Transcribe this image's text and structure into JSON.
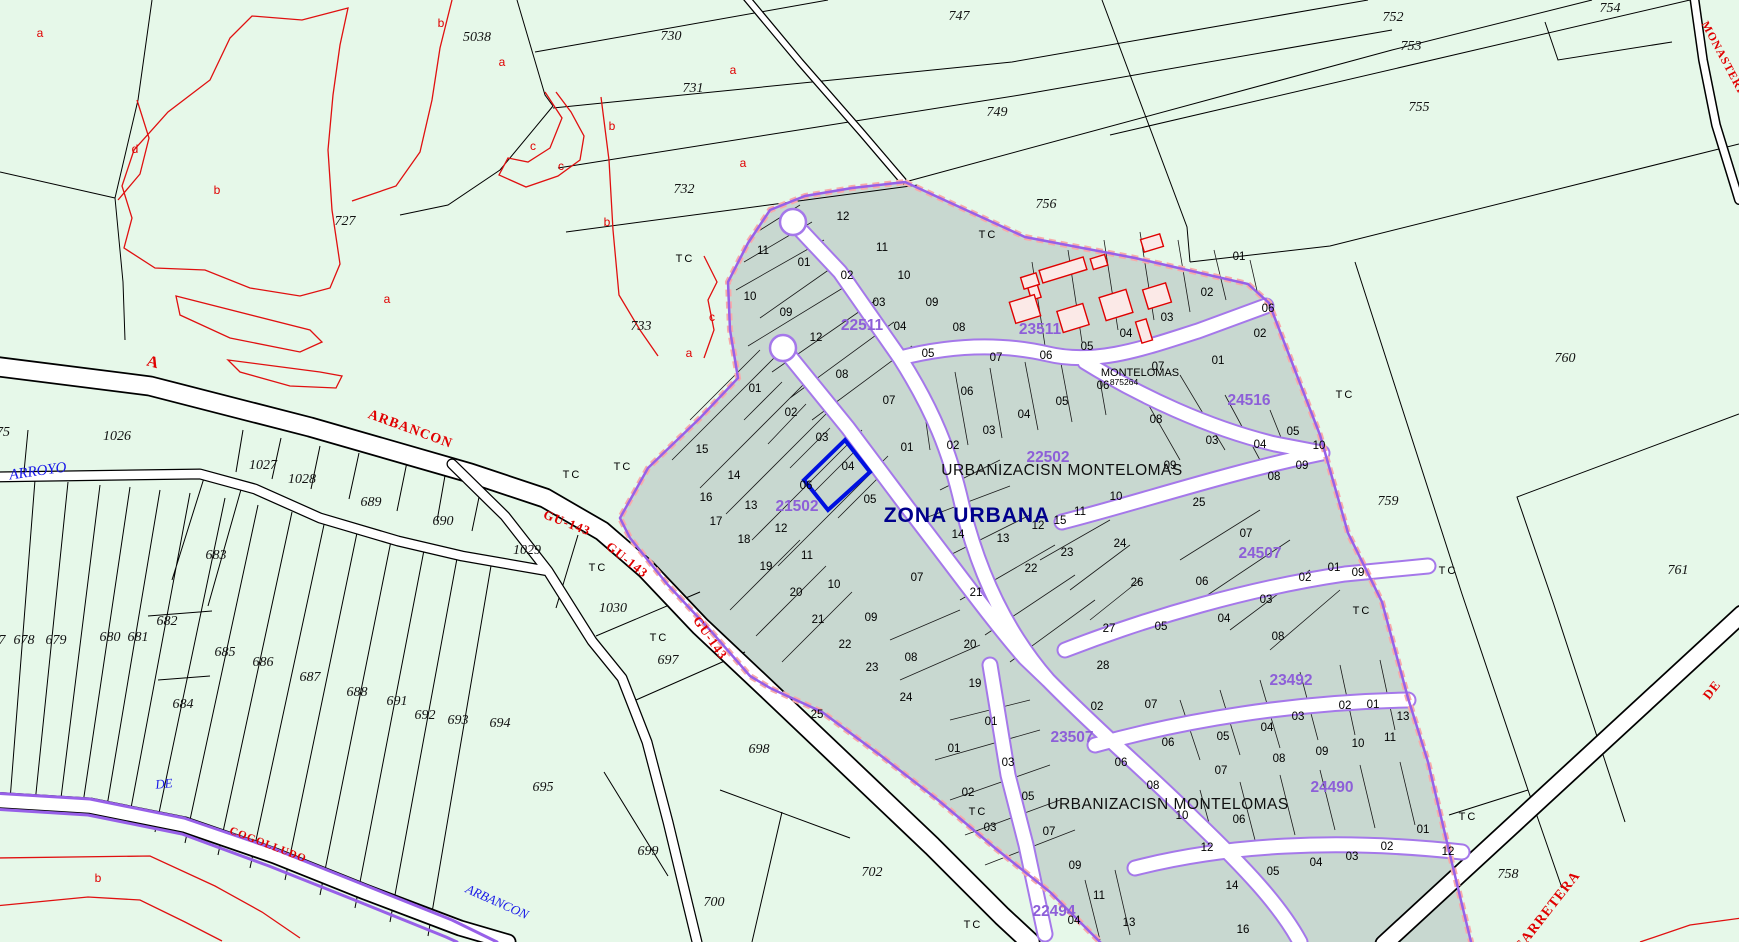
{
  "map": {
    "width": 1739,
    "height": 942,
    "colors": {
      "rural_fill": "#e6f8e9",
      "urban_fill": "#c8d8d0",
      "parcel_line": "#000000",
      "subparcel_red": "#e01010",
      "urban_boundary_purple": "#9760e8",
      "urban_boundary_pink": "#f8aaaa",
      "road_casing_purple": "#a578ea",
      "cadastral_ref_purple": "#8d5fd8",
      "hydro_blue": "#1818e8",
      "zone_navy": "#00008c",
      "selected_parcel_blue": "#0010e0",
      "house_fill": "#fbe9e7",
      "house_stroke": "#e00000"
    }
  },
  "labels": {
    "zone_label": [
      [
        967,
        516,
        "ZONA URBANA",
        0
      ]
    ],
    "urbanization_labels": [
      [
        1062,
        471,
        "URBANIZACISN MONTELOMAS",
        0
      ],
      [
        1168,
        805,
        "URBANIZACISN MONTELOMAS",
        0
      ]
    ],
    "small_labels": [
      [
        1140,
        373,
        "MONTELOMAS",
        0,
        11
      ],
      [
        1124,
        382,
        "875264",
        0,
        8.5
      ]
    ],
    "cadastral_refs": [
      [
        862,
        326,
        "22511",
        0
      ],
      [
        1040,
        330,
        "23511",
        0
      ],
      [
        1048,
        458,
        "22502",
        0
      ],
      [
        1249,
        401,
        "24516",
        0
      ],
      [
        797,
        507,
        "21502",
        0
      ],
      [
        1260,
        554,
        "24507",
        0
      ],
      [
        1291,
        681,
        "23492",
        0
      ],
      [
        1072,
        738,
        "23507",
        0
      ],
      [
        1332,
        788,
        "24490",
        0
      ],
      [
        1054,
        912,
        "22494",
        0
      ]
    ],
    "rural_parcel_numbers": [
      [
        477,
        38,
        "5038",
        0
      ],
      [
        345,
        222,
        "727",
        0
      ],
      [
        671,
        37,
        "730",
        0
      ],
      [
        693,
        89,
        "731",
        0
      ],
      [
        684,
        190,
        "732",
        0
      ],
      [
        641,
        327,
        "733",
        0
      ],
      [
        959,
        17,
        "747",
        0
      ],
      [
        997,
        113,
        "749",
        0
      ],
      [
        1046,
        205,
        "756",
        0
      ],
      [
        1393,
        18,
        "752",
        0
      ],
      [
        1411,
        47,
        "753",
        0
      ],
      [
        1610,
        9,
        "754",
        0
      ],
      [
        1419,
        108,
        "755",
        0
      ],
      [
        1565,
        359,
        "760",
        0
      ],
      [
        1388,
        502,
        "759",
        0
      ],
      [
        1678,
        571,
        "761",
        0
      ],
      [
        1508,
        875,
        "758",
        0
      ],
      [
        117,
        437,
        "1026",
        0
      ],
      [
        263,
        466,
        "1027",
        0
      ],
      [
        302,
        480,
        "1028",
        0
      ],
      [
        371,
        503,
        "689",
        0
      ],
      [
        443,
        522,
        "690",
        0
      ],
      [
        527,
        551,
        "1029",
        0
      ],
      [
        613,
        609,
        "1030",
        0
      ],
      [
        216,
        556,
        "683",
        0
      ],
      [
        3,
        433,
        "75",
        0
      ],
      [
        2,
        641,
        "7",
        0
      ],
      [
        24,
        641,
        "678",
        0
      ],
      [
        56,
        641,
        "679",
        0
      ],
      [
        110,
        638,
        "680",
        0
      ],
      [
        138,
        638,
        "681",
        0
      ],
      [
        167,
        622,
        "682",
        0
      ],
      [
        183,
        705,
        "684",
        0
      ],
      [
        225,
        653,
        "685",
        0
      ],
      [
        263,
        663,
        "686",
        0
      ],
      [
        310,
        678,
        "687",
        0
      ],
      [
        357,
        693,
        "688",
        0
      ],
      [
        397,
        702,
        "691",
        0
      ],
      [
        425,
        716,
        "692",
        0
      ],
      [
        458,
        721,
        "693",
        0
      ],
      [
        500,
        724,
        "694",
        0
      ],
      [
        543,
        788,
        "695",
        0
      ],
      [
        668,
        661,
        "697",
        0
      ],
      [
        759,
        750,
        "698",
        0
      ],
      [
        648,
        852,
        "699",
        0
      ],
      [
        714,
        903,
        "700",
        0
      ],
      [
        872,
        873,
        "702",
        0
      ]
    ],
    "tc_markers": [
      [
        685,
        259,
        "TC",
        0
      ],
      [
        988,
        235,
        "TC",
        0
      ],
      [
        572,
        475,
        "TC",
        0
      ],
      [
        623,
        467,
        "TC",
        0
      ],
      [
        598,
        568,
        "TC",
        0
      ],
      [
        659,
        638,
        "TC",
        0
      ],
      [
        1345,
        395,
        "TC",
        0
      ],
      [
        1448,
        571,
        "TC",
        0
      ],
      [
        1362,
        611,
        "TC",
        0
      ],
      [
        1468,
        817,
        "TC",
        0
      ],
      [
        978,
        812,
        "TC",
        0
      ],
      [
        973,
        925,
        "TC",
        0
      ]
    ],
    "subparcel_letters": [
      [
        40,
        33,
        "a",
        0
      ],
      [
        441,
        23,
        "b",
        0
      ],
      [
        502,
        62,
        "a",
        0
      ],
      [
        733,
        70,
        "a",
        0
      ],
      [
        612,
        126,
        "b",
        0
      ],
      [
        135,
        149,
        "d",
        0
      ],
      [
        533,
        146,
        "c",
        0
      ],
      [
        561,
        166,
        "c",
        0
      ],
      [
        743,
        163,
        "a",
        0
      ],
      [
        217,
        190,
        "b",
        0
      ],
      [
        607,
        222,
        "b",
        0
      ],
      [
        387,
        299,
        "a",
        0
      ],
      [
        712,
        317,
        "c",
        0
      ],
      [
        689,
        353,
        "a",
        0
      ],
      [
        98,
        878,
        "b",
        0
      ]
    ],
    "road_labels": [
      [
        410,
        430,
        "ARBANCON",
        20,
        14
      ],
      [
        567,
        523,
        "GU-143",
        21,
        13
      ],
      [
        627,
        560,
        "GU-143",
        38,
        13
      ],
      [
        710,
        638,
        "GU-143",
        55,
        13
      ],
      [
        268,
        845,
        "COGOLLUDO",
        21,
        11
      ],
      [
        1548,
        912,
        "CARRETERA",
        -52,
        14
      ],
      [
        1712,
        690,
        "DE",
        -52,
        13
      ],
      [
        1725,
        62,
        "MONASTERIO",
        62,
        11.5
      ],
      [
        153,
        363,
        "A",
        15,
        16
      ]
    ],
    "blue_labels": [
      [
        38,
        472,
        "ARROYO",
        -8,
        15
      ],
      [
        164,
        784,
        "DE",
        -5,
        13
      ],
      [
        497,
        902,
        "ARBANCON",
        24,
        13
      ]
    ],
    "urban_parcel_numbers": [
      [
        843,
        217,
        "12",
        0
      ],
      [
        763,
        251,
        "11",
        0
      ],
      [
        882,
        248,
        "11",
        0
      ],
      [
        804,
        263,
        "01",
        0
      ],
      [
        847,
        276,
        "02",
        0
      ],
      [
        904,
        276,
        "10",
        0
      ],
      [
        750,
        297,
        "10",
        0
      ],
      [
        786,
        313,
        "09",
        0
      ],
      [
        879,
        303,
        "03",
        0
      ],
      [
        932,
        303,
        "09",
        0
      ],
      [
        816,
        338,
        "12",
        0
      ],
      [
        900,
        327,
        "04",
        0
      ],
      [
        959,
        328,
        "08",
        0
      ],
      [
        928,
        354,
        "05",
        0
      ],
      [
        996,
        358,
        "07",
        0
      ],
      [
        842,
        375,
        "08",
        0
      ],
      [
        967,
        392,
        "06",
        0
      ],
      [
        889,
        401,
        "07",
        0
      ],
      [
        755,
        389,
        "01",
        0
      ],
      [
        791,
        413,
        "02",
        0
      ],
      [
        822,
        438,
        "03",
        0
      ],
      [
        848,
        467,
        "04",
        0
      ],
      [
        870,
        500,
        "05",
        0
      ],
      [
        806,
        486,
        "06",
        0
      ],
      [
        702,
        450,
        "15",
        0
      ],
      [
        734,
        476,
        "14",
        0
      ],
      [
        706,
        498,
        "16",
        0
      ],
      [
        751,
        506,
        "13",
        0
      ],
      [
        716,
        522,
        "17",
        0
      ],
      [
        781,
        529,
        "12",
        0
      ],
      [
        744,
        540,
        "18",
        0
      ],
      [
        807,
        556,
        "11",
        0
      ],
      [
        766,
        567,
        "19",
        0
      ],
      [
        834,
        585,
        "10",
        0
      ],
      [
        796,
        593,
        "20",
        0
      ],
      [
        818,
        620,
        "21",
        0
      ],
      [
        871,
        618,
        "09",
        0
      ],
      [
        845,
        645,
        "22",
        0
      ],
      [
        872,
        668,
        "23",
        0
      ],
      [
        911,
        658,
        "08",
        0
      ],
      [
        906,
        698,
        "24",
        0
      ],
      [
        817,
        715,
        "25",
        0
      ],
      [
        1239,
        257,
        "01",
        0
      ],
      [
        1207,
        293,
        "02",
        0
      ],
      [
        1167,
        318,
        "03",
        0
      ],
      [
        1126,
        334,
        "04",
        0
      ],
      [
        1087,
        347,
        "05",
        0
      ],
      [
        1046,
        356,
        "06",
        0
      ],
      [
        1268,
        309,
        "06",
        0
      ],
      [
        1260,
        334,
        "02",
        0
      ],
      [
        1218,
        361,
        "01",
        0
      ],
      [
        1158,
        367,
        "07",
        0
      ],
      [
        1103,
        386,
        "06",
        0
      ],
      [
        1062,
        402,
        "05",
        0
      ],
      [
        1024,
        415,
        "04",
        0
      ],
      [
        989,
        431,
        "03",
        0
      ],
      [
        953,
        446,
        "02",
        0
      ],
      [
        907,
        448,
        "01",
        0
      ],
      [
        1156,
        420,
        "08",
        0
      ],
      [
        1170,
        466,
        "09",
        0
      ],
      [
        1212,
        441,
        "03",
        0
      ],
      [
        1260,
        445,
        "04",
        0
      ],
      [
        1293,
        432,
        "05",
        0
      ],
      [
        1319,
        446,
        "10",
        0
      ],
      [
        1302,
        466,
        "09",
        0
      ],
      [
        1274,
        477,
        "08",
        0
      ],
      [
        1116,
        497,
        "10",
        0
      ],
      [
        1199,
        503,
        "25",
        0
      ],
      [
        958,
        535,
        "14",
        0
      ],
      [
        1003,
        539,
        "13",
        0
      ],
      [
        1038,
        526,
        "12",
        0
      ],
      [
        1060,
        521,
        "15",
        0
      ],
      [
        1080,
        512,
        "11",
        0
      ],
      [
        917,
        578,
        "07",
        0
      ],
      [
        1067,
        553,
        "23",
        0
      ],
      [
        1120,
        544,
        "24",
        0
      ],
      [
        1031,
        569,
        "22",
        0
      ],
      [
        976,
        593,
        "21",
        0
      ],
      [
        970,
        645,
        "20",
        0
      ],
      [
        1137,
        583,
        "26",
        0
      ],
      [
        1109,
        629,
        "27",
        0
      ],
      [
        1103,
        666,
        "28",
        0
      ],
      [
        975,
        684,
        "19",
        0
      ],
      [
        1246,
        534,
        "07",
        0
      ],
      [
        1202,
        582,
        "06",
        0
      ],
      [
        1161,
        627,
        "05",
        0
      ],
      [
        1224,
        619,
        "04",
        0
      ],
      [
        1266,
        600,
        "03",
        0
      ],
      [
        1305,
        578,
        "02",
        0
      ],
      [
        1334,
        568,
        "01",
        0
      ],
      [
        1358,
        573,
        "09",
        0
      ],
      [
        1278,
        637,
        "08",
        0
      ],
      [
        1345,
        706,
        "02",
        0
      ],
      [
        1373,
        705,
        "01",
        0
      ],
      [
        1403,
        717,
        "13",
        0
      ],
      [
        1298,
        717,
        "03",
        0
      ],
      [
        1267,
        728,
        "04",
        0
      ],
      [
        1223,
        737,
        "05",
        0
      ],
      [
        1168,
        743,
        "06",
        0
      ],
      [
        1151,
        705,
        "07",
        0
      ],
      [
        1390,
        738,
        "11",
        0
      ],
      [
        1358,
        744,
        "10",
        0
      ],
      [
        1322,
        752,
        "09",
        0
      ],
      [
        1279,
        759,
        "08",
        0
      ],
      [
        1221,
        771,
        "07",
        0
      ],
      [
        1153,
        786,
        "08",
        0
      ],
      [
        1121,
        763,
        "06",
        0
      ],
      [
        1097,
        707,
        "02",
        0
      ],
      [
        1239,
        820,
        "06",
        0
      ],
      [
        1182,
        816,
        "10",
        0
      ],
      [
        1207,
        848,
        "12",
        0
      ],
      [
        1423,
        830,
        "01",
        0
      ],
      [
        1387,
        847,
        "02",
        0
      ],
      [
        1352,
        857,
        "03",
        0
      ],
      [
        1316,
        863,
        "04",
        0
      ],
      [
        1273,
        872,
        "05",
        0
      ],
      [
        1448,
        852,
        "12",
        0
      ],
      [
        1232,
        886,
        "14",
        0
      ],
      [
        1243,
        930,
        "16",
        0
      ],
      [
        991,
        722,
        "01",
        0
      ],
      [
        954,
        749,
        "01",
        0
      ],
      [
        1008,
        763,
        "03",
        0
      ],
      [
        968,
        793,
        "02",
        0
      ],
      [
        1028,
        797,
        "05",
        0
      ],
      [
        990,
        828,
        "03",
        0
      ],
      [
        1049,
        832,
        "07",
        0
      ],
      [
        1075,
        866,
        "09",
        0
      ],
      [
        1099,
        896,
        "11",
        0
      ],
      [
        1074,
        921,
        "04",
        0
      ],
      [
        1129,
        923,
        "13",
        0
      ]
    ]
  }
}
